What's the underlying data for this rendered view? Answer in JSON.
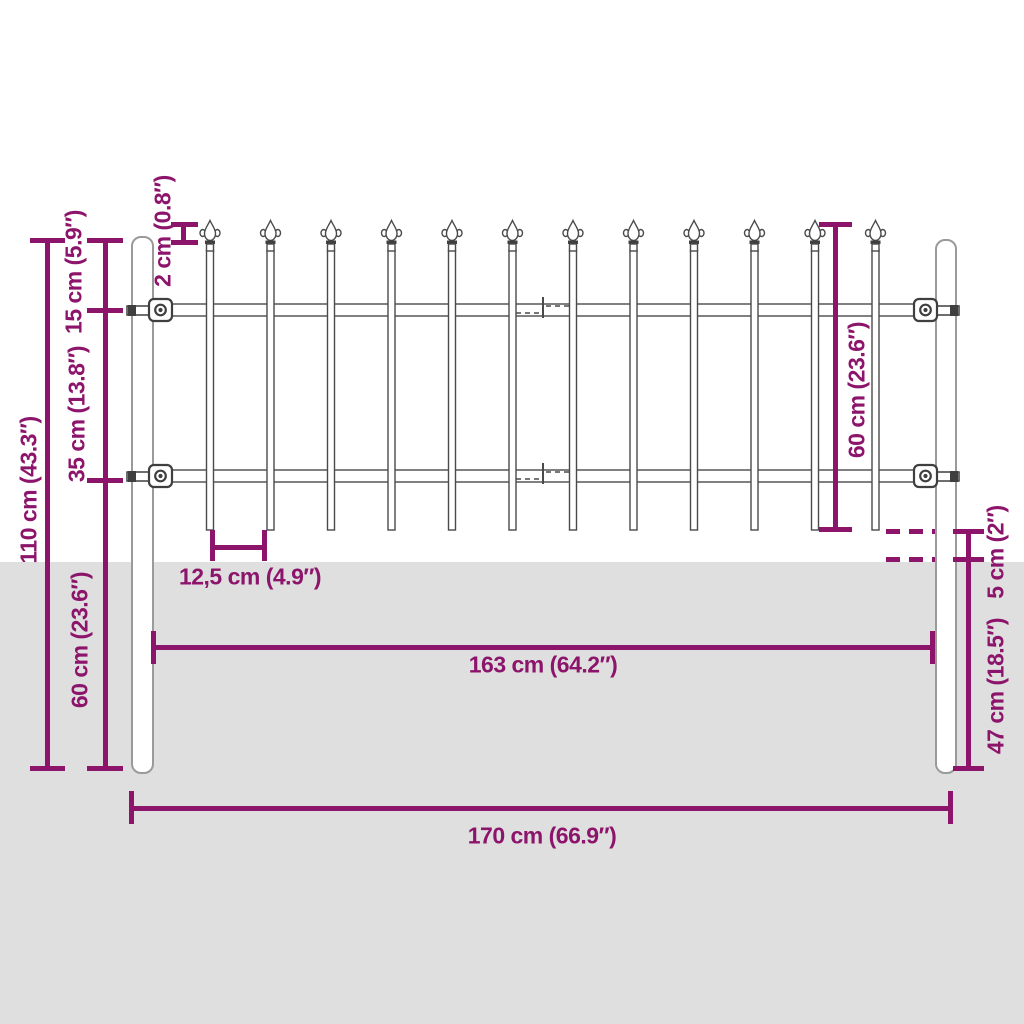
{
  "diagram": {
    "type": "product-dimension-diagram",
    "subject": "garden fence panel with spear-top pickets and ground posts"
  },
  "colors": {
    "dimension_accent": "#8C156B",
    "ground": "#DFDFDF",
    "background": "#FFFFFF",
    "fence_outline": "#4A4A4A",
    "post_outline": "#9A9A9A"
  },
  "fence": {
    "picket_count": 12,
    "rail_count": 2,
    "post_count": 2
  },
  "dimensions": {
    "total_height": "110 cm (43.3″)",
    "post_top_to_rail": "15 cm (5.9″)",
    "rail_spacing": "35 cm (13.8″)",
    "rail_to_post_bottom": "60 cm (23.6″)",
    "spear_height": "2 cm (0.8″)",
    "panel_height": "60 cm (23.6″)",
    "picket_spacing": "12,5 cm (4.9″)",
    "panel_width": "163 cm (64.2″)",
    "total_width": "170 cm (66.9″)",
    "ground_clearance": "5 cm (2″)",
    "ground_depth": "47 cm (18.5″)"
  }
}
